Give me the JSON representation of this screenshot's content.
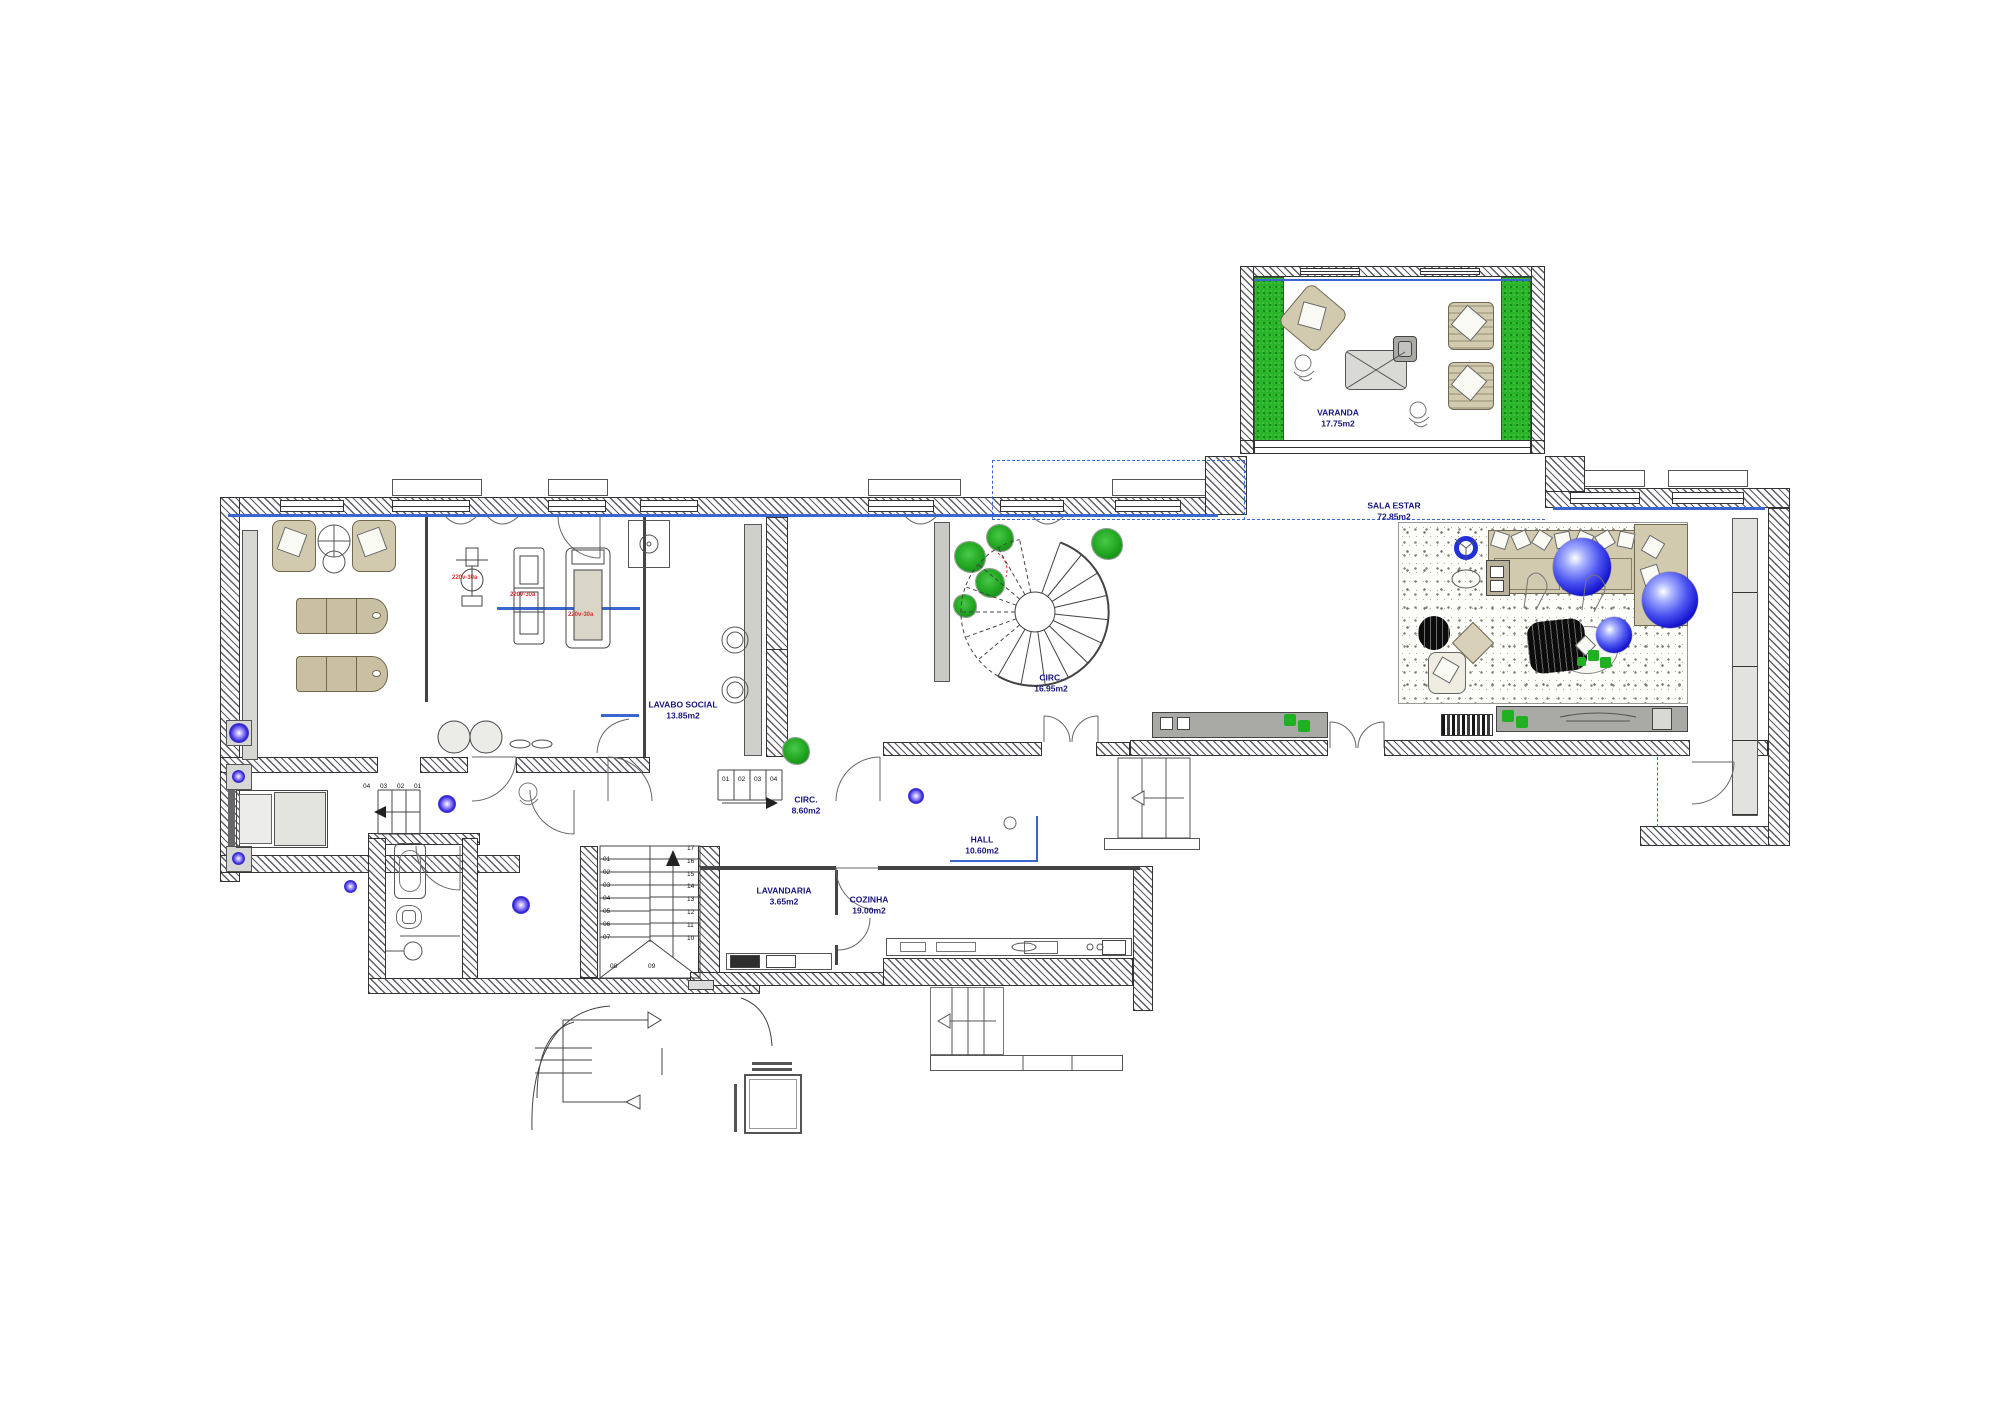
{
  "plan": {
    "rooms": [
      {
        "key": "varanda",
        "name": "VARANDA",
        "area": "17.75m2"
      },
      {
        "key": "sala-estar",
        "name": "SALA ESTAR",
        "area": "72.85m2"
      },
      {
        "key": "lavabo-social",
        "name": "LAVABO SOCIAL",
        "area": "13.85m2"
      },
      {
        "key": "circ-spiral",
        "name": "CIRC.",
        "area": "16.95m2"
      },
      {
        "key": "circ-entry",
        "name": "CIRC.",
        "area": "8.60m2"
      },
      {
        "key": "hall",
        "name": "HALL",
        "area": "10.60m2"
      },
      {
        "key": "lavandaria",
        "name": "LAVANDARIA",
        "area": "3.65m2"
      },
      {
        "key": "cozinha",
        "name": "COZINHA",
        "area": "19.00m2"
      }
    ],
    "stairs": {
      "main_left": [
        "01",
        "02",
        "03",
        "04",
        "05",
        "06",
        "07"
      ],
      "main_right": [
        "17",
        "16",
        "15",
        "14",
        "13",
        "12",
        "11",
        "10"
      ],
      "landing": [
        "08",
        "09"
      ],
      "bed_steps": [
        "04",
        "03",
        "02",
        "01"
      ],
      "entry_steps": [
        "01",
        "02",
        "03",
        "04"
      ]
    },
    "notes": {
      "electrical": [
        "220v-30a",
        "220v-30a",
        "220v-30a"
      ]
    },
    "colors": {
      "label_blue": "#18157f",
      "note_red": "#e03131",
      "plant_green": "#21b021",
      "sphere_blue": "#1f2bd8",
      "line_blue": "#3a66d0",
      "furniture_beige": "#cfc6aa",
      "wall_ink": "#333333"
    }
  }
}
